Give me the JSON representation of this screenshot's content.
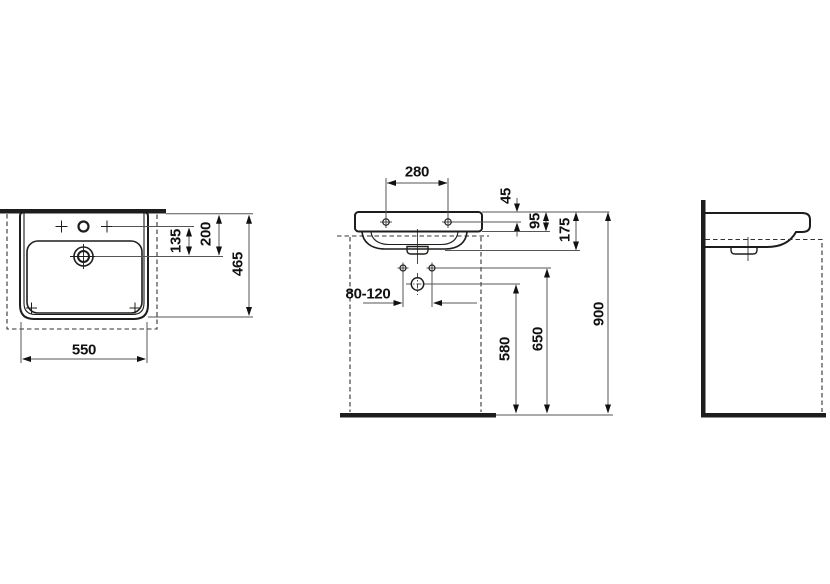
{
  "drawing": {
    "type": "washbasin-installation-technical-drawing",
    "views": [
      "top-view",
      "front-view",
      "side-view"
    ],
    "colors": {
      "object_line": "#1d1d1b",
      "dimension_line": "#555555",
      "text": "#111111",
      "background": "#ffffff"
    },
    "dimensions": {
      "basin_width": "550",
      "basin_depth": "465",
      "drain_to_wall": "200",
      "tap_to_drain": "135",
      "fixing_hole_spacing": "280",
      "rim_to_fixing_holes": "45",
      "rim_edge_height": "95",
      "ceramic_height": "175",
      "supply_spacing": "80-120",
      "waste_outlet_height": "580",
      "supply_height": "650",
      "rim_height": "900"
    }
  }
}
